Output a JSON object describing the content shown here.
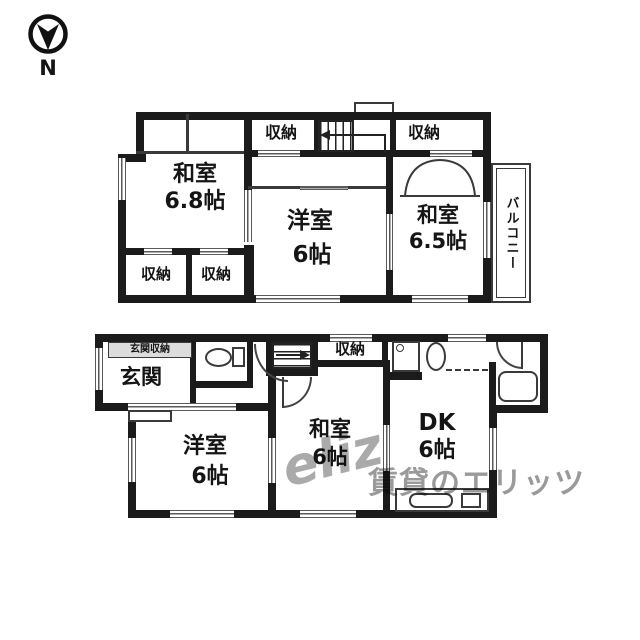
{
  "compass": {
    "label": "N"
  },
  "upper_floor": {
    "rooms": {
      "washitsu68": {
        "label": "和室",
        "size": "6.8帖"
      },
      "youshitsu": {
        "label": "洋室",
        "size": "6帖"
      },
      "washitsu65": {
        "label": "和室",
        "size": "6.5帖"
      },
      "closet_top": {
        "label": "収納"
      },
      "closet_right": {
        "label": "収納"
      },
      "closet_b1": {
        "label": "収納"
      },
      "closet_b2": {
        "label": "収納"
      },
      "balcony": {
        "label": "バルコニー"
      }
    }
  },
  "lower_floor": {
    "rooms": {
      "genkan": {
        "label": "玄関"
      },
      "genkan_storage": {
        "label": "玄関収納"
      },
      "closet": {
        "label": "収納"
      },
      "youshitsu": {
        "label": "洋室",
        "size": "6帖"
      },
      "washitsu": {
        "label": "和室",
        "size": "6帖"
      },
      "dk": {
        "label": "DK",
        "size": "6帖"
      }
    }
  },
  "watermark": {
    "logo_text": "eliz",
    "text": "賃貸のエリッツ"
  },
  "colors": {
    "wall": "#1b1b1b",
    "thin_line": "#3a3a3a",
    "window_line": "#5a5a5a",
    "shade": "#dcdcdc",
    "watermark_gray": "#7d7d7d",
    "background": "#ffffff"
  },
  "icons": {
    "compass": "circle with filled chevron arrow, N below",
    "toilet": "oval bowl + tank rectangle",
    "washbasin": "small oval",
    "washing_machine": "square with corner circle",
    "bathtub": "rounded rectangle in black block",
    "kitchen_sink": "rounded rectangle in counter",
    "stove": "small square in counter",
    "stairs": "parallel tread lines with direction arrow",
    "door": "quarter-circle swing arc",
    "closet_double_door": "double arc tent curve"
  }
}
